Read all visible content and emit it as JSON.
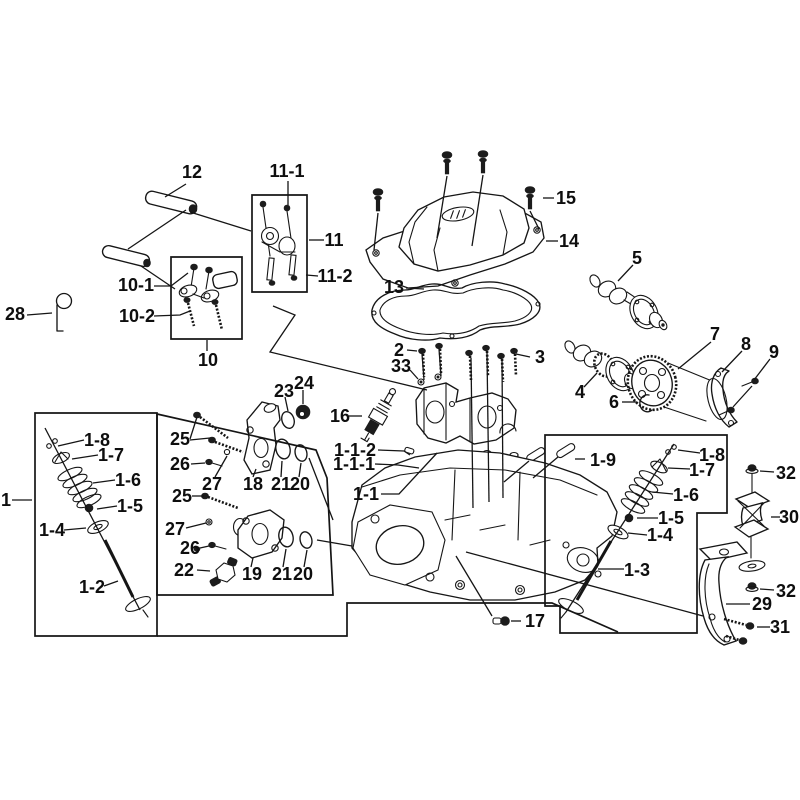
{
  "figure": {
    "type": "exploded-parts-diagram",
    "subject": "engine cylinder head assembly",
    "background_color": "#ffffff",
    "line_color": "#151515",
    "label_color": "#0e0e0e"
  },
  "labels": [
    {
      "id": "label-12",
      "t": "12",
      "x": 192,
      "y": 172
    },
    {
      "id": "label-11-1",
      "t": "11-1",
      "x": 287,
      "y": 171
    },
    {
      "id": "label-11",
      "t": "11",
      "x": 334,
      "y": 240
    },
    {
      "id": "label-11-2",
      "t": "11-2",
      "x": 335,
      "y": 276
    },
    {
      "id": "label-10-1",
      "t": "10-1",
      "x": 136,
      "y": 285
    },
    {
      "id": "label-10-2",
      "t": "10-2",
      "x": 137,
      "y": 316
    },
    {
      "id": "label-10",
      "t": "10",
      "x": 208,
      "y": 360
    },
    {
      "id": "label-28",
      "t": "28",
      "x": 15,
      "y": 314
    },
    {
      "id": "label-15",
      "t": "15",
      "x": 566,
      "y": 198
    },
    {
      "id": "label-14",
      "t": "14",
      "x": 569,
      "y": 241
    },
    {
      "id": "label-13",
      "t": "13",
      "x": 394,
      "y": 287
    },
    {
      "id": "label-5",
      "t": "5",
      "x": 637,
      "y": 258
    },
    {
      "id": "label-7",
      "t": "7",
      "x": 715,
      "y": 334
    },
    {
      "id": "label-8",
      "t": "8",
      "x": 746,
      "y": 344
    },
    {
      "id": "label-9",
      "t": "9",
      "x": 774,
      "y": 352
    },
    {
      "id": "label-4",
      "t": "4",
      "x": 580,
      "y": 392
    },
    {
      "id": "label-6",
      "t": "6",
      "x": 614,
      "y": 402
    },
    {
      "id": "label-2",
      "t": "2",
      "x": 399,
      "y": 350
    },
    {
      "id": "label-33",
      "t": "33",
      "x": 401,
      "y": 366
    },
    {
      "id": "label-3",
      "t": "3",
      "x": 540,
      "y": 357
    },
    {
      "id": "label-16",
      "t": "16",
      "x": 340,
      "y": 416
    },
    {
      "id": "label-1-1-2",
      "t": "1-1-2",
      "x": 355,
      "y": 450
    },
    {
      "id": "label-1-1-1",
      "t": "1-1-1",
      "x": 354,
      "y": 464
    },
    {
      "id": "label-1-1",
      "t": "1-1",
      "x": 366,
      "y": 494
    },
    {
      "id": "label-1",
      "t": "1",
      "x": 6,
      "y": 500
    },
    {
      "id": "label-1-8-left",
      "t": "1-8",
      "x": 97,
      "y": 440
    },
    {
      "id": "label-1-7-left",
      "t": "1-7",
      "x": 111,
      "y": 455
    },
    {
      "id": "label-1-6-left",
      "t": "1-6",
      "x": 128,
      "y": 480
    },
    {
      "id": "label-1-5-left",
      "t": "1-5",
      "x": 130,
      "y": 506
    },
    {
      "id": "label-1-4-left",
      "t": "1-4",
      "x": 52,
      "y": 530
    },
    {
      "id": "label-1-2",
      "t": "1-2",
      "x": 92,
      "y": 587
    },
    {
      "id": "label-23",
      "t": "23",
      "x": 284,
      "y": 391
    },
    {
      "id": "label-24",
      "t": "24",
      "x": 304,
      "y": 383
    },
    {
      "id": "label-25-top",
      "t": "25",
      "x": 180,
      "y": 439
    },
    {
      "id": "label-26-top",
      "t": "26",
      "x": 180,
      "y": 464
    },
    {
      "id": "label-27-top",
      "t": "27",
      "x": 212,
      "y": 484
    },
    {
      "id": "label-18",
      "t": "18",
      "x": 253,
      "y": 484
    },
    {
      "id": "label-21-top",
      "t": "21",
      "x": 281,
      "y": 484
    },
    {
      "id": "label-20-top",
      "t": "20",
      "x": 300,
      "y": 484
    },
    {
      "id": "label-25-bottom",
      "t": "25",
      "x": 182,
      "y": 496
    },
    {
      "id": "label-27-bottom",
      "t": "27",
      "x": 175,
      "y": 529
    },
    {
      "id": "label-26-bottom",
      "t": "26",
      "x": 190,
      "y": 548
    },
    {
      "id": "label-22",
      "t": "22",
      "x": 184,
      "y": 570
    },
    {
      "id": "label-19",
      "t": "19",
      "x": 252,
      "y": 574
    },
    {
      "id": "label-21-bottom",
      "t": "21",
      "x": 282,
      "y": 574
    },
    {
      "id": "label-20-bottom",
      "t": "20",
      "x": 303,
      "y": 574
    },
    {
      "id": "label-1-9",
      "t": "1-9",
      "x": 603,
      "y": 460
    },
    {
      "id": "label-1-8-right",
      "t": "1-8",
      "x": 712,
      "y": 455
    },
    {
      "id": "label-1-7-right",
      "t": "1-7",
      "x": 702,
      "y": 470
    },
    {
      "id": "label-1-6-right",
      "t": "1-6",
      "x": 686,
      "y": 495
    },
    {
      "id": "label-1-5-right",
      "t": "1-5",
      "x": 671,
      "y": 518
    },
    {
      "id": "label-1-4-right",
      "t": "1-4",
      "x": 660,
      "y": 535
    },
    {
      "id": "label-1-3",
      "t": "1-3",
      "x": 637,
      "y": 570
    },
    {
      "id": "label-32-top",
      "t": "32",
      "x": 786,
      "y": 473
    },
    {
      "id": "label-30",
      "t": "30",
      "x": 789,
      "y": 517
    },
    {
      "id": "label-32-bottom",
      "t": "32",
      "x": 786,
      "y": 591
    },
    {
      "id": "label-29",
      "t": "29",
      "x": 762,
      "y": 604
    },
    {
      "id": "label-31",
      "t": "31",
      "x": 780,
      "y": 627
    },
    {
      "id": "label-17",
      "t": "17",
      "x": 535,
      "y": 621
    }
  ],
  "callout_boxes": [
    {
      "id": "group-box-valve-left",
      "closed": true,
      "pts": "35,413 157,413 157,636 35,636"
    },
    {
      "id": "group-box-manifolds",
      "closed": true,
      "pts": "157,414 316,450 327,478 333,595 157,595"
    },
    {
      "id": "group-outline-head-band",
      "closed": false,
      "pts": "157,636 347,636 347,603 552,603 618,632"
    },
    {
      "id": "group-box-valve-right",
      "closed": true,
      "pts": "545,435 727,435 727,513 697,513 697,633 560,633 560,606 545,606"
    },
    {
      "id": "group-box-rocker-10",
      "closed": true,
      "pts": "171,257 242,257 242,339 171,339"
    },
    {
      "id": "group-box-rocker-11",
      "closed": true,
      "pts": "252,195 307,195 307,292 252,292"
    }
  ],
  "leader_lines": [
    {
      "id": "ld-12",
      "pts": "186,184 165,197"
    },
    {
      "id": "ld-12-axis",
      "pts": "186,210 128,249"
    },
    {
      "id": "ld-pin-box10",
      "pts": "141,266 175,289"
    },
    {
      "id": "ld-pin-box11",
      "pts": "190,212 251,231"
    },
    {
      "id": "ld-11-1",
      "pts": "288,181 288,205"
    },
    {
      "id": "ld-11",
      "pts": "309,240 324,240"
    },
    {
      "id": "ld-11-2",
      "pts": "306,275 318,276"
    },
    {
      "id": "ld-10-1",
      "pts": "154,286 171,286 188,273"
    },
    {
      "id": "ld-10-2",
      "pts": "154,316 180,315 190,311"
    },
    {
      "id": "ld-10",
      "pts": "207,351 207,340"
    },
    {
      "id": "ld-28",
      "pts": "27,315 52,313"
    },
    {
      "id": "ld-15",
      "pts": "543,198 554,198"
    },
    {
      "id": "ld-14",
      "pts": "546,241 558,241"
    },
    {
      "id": "ld-13",
      "pts": "406,288 424,289"
    },
    {
      "id": "ld-5",
      "pts": "633,265 618,281"
    },
    {
      "id": "ld-4",
      "pts": "584,387 597,373"
    },
    {
      "id": "ld-7",
      "pts": "711,342 678,369"
    },
    {
      "id": "ld-8",
      "pts": "742,351 722,372"
    },
    {
      "id": "ld-9",
      "pts": "770,359 754,380"
    },
    {
      "id": "ld-9b",
      "pts": "752,386 733,407"
    },
    {
      "id": "ld-6",
      "pts": "622,402 637,402"
    },
    {
      "id": "ld-2",
      "pts": "407,350 417,351"
    },
    {
      "id": "ld-33",
      "pts": "410,370 418,379"
    },
    {
      "id": "ld-3",
      "pts": "530,357 516,354"
    },
    {
      "id": "ld-16",
      "pts": "349,416 362,416"
    },
    {
      "id": "ld-1-1-2",
      "pts": "378,450 404,451 410,455"
    },
    {
      "id": "ld-1-1-1",
      "pts": "375,464 398,465 419,468"
    },
    {
      "id": "ld-1-1",
      "pts": "381,494 399,494 437,453"
    },
    {
      "id": "ld-1",
      "pts": "12,500 32,500"
    },
    {
      "id": "ld-1-8L",
      "pts": "84,440 58,446"
    },
    {
      "id": "ld-1-7L",
      "pts": "98,455 72,459"
    },
    {
      "id": "ld-1-6L",
      "pts": "115,480 93,483"
    },
    {
      "id": "ld-1-5L",
      "pts": "117,506 97,509"
    },
    {
      "id": "ld-1-4L",
      "pts": "64,530 86,528"
    },
    {
      "id": "ld-1-2",
      "pts": "104,586 118,581"
    },
    {
      "id": "ld-23",
      "pts": "285,397 288,411"
    },
    {
      "id": "ld-24",
      "pts": "303,390 303,404"
    },
    {
      "id": "ld-25a",
      "pts": "190,439 197,417"
    },
    {
      "id": "ld-25a2",
      "pts": "190,440 210,438"
    },
    {
      "id": "ld-26a",
      "pts": "191,464 205,463"
    },
    {
      "id": "ld-27a",
      "pts": "215,477 227,456"
    },
    {
      "id": "ld-18",
      "pts": "253,477 256,469"
    },
    {
      "id": "ld-21a",
      "pts": "281,477 282,461"
    },
    {
      "id": "ld-20a",
      "pts": "299,477 301,463"
    },
    {
      "id": "ld-25b",
      "pts": "192,496 204,496"
    },
    {
      "id": "ld-27b",
      "pts": "186,528 206,523"
    },
    {
      "id": "ld-26b",
      "pts": "200,548 209,546"
    },
    {
      "id": "ld-22",
      "pts": "197,570 210,571"
    },
    {
      "id": "ld-19",
      "pts": "251,567 253,558"
    },
    {
      "id": "ld-21b",
      "pts": "283,567 286,549"
    },
    {
      "id": "ld-20b",
      "pts": "304,567 307,550"
    },
    {
      "id": "ld-oring-head-1",
      "pts": "309,458 333,520"
    },
    {
      "id": "ld-oring-head-2",
      "pts": "317,540 352,546"
    },
    {
      "id": "ld-1-9",
      "pts": "575,459 585,459"
    },
    {
      "id": "ld-pin-a",
      "pts": "529,461 504,482"
    },
    {
      "id": "ld-pin-b",
      "pts": "558,457 533,478"
    },
    {
      "id": "ld-1-8R",
      "pts": "700,453 678,450"
    },
    {
      "id": "ld-1-7R",
      "pts": "690,469 668,468"
    },
    {
      "id": "ld-1-6R",
      "pts": "673,494 652,492"
    },
    {
      "id": "ld-1-5R",
      "pts": "658,518 637,518"
    },
    {
      "id": "ld-1-4R",
      "pts": "647,535 628,533"
    },
    {
      "id": "ld-1-3",
      "pts": "624,569 598,569"
    },
    {
      "id": "ld-32a",
      "pts": "760,471 774,472"
    },
    {
      "id": "ld-30",
      "pts": "771,517 780,517"
    },
    {
      "id": "ld-32b",
      "pts": "760,589 774,590"
    },
    {
      "id": "ld-29",
      "pts": "726,604 750,604"
    },
    {
      "id": "ld-31",
      "pts": "757,627 770,627"
    },
    {
      "id": "ld-17-diag",
      "pts": "456,556 492,616"
    },
    {
      "id": "ld-17",
      "pts": "511,621 521,621"
    },
    {
      "id": "ld-29-long",
      "pts": "466,552 703,616"
    },
    {
      "id": "ld-zigzag-11",
      "pts": "273,306 295,315 270,352 427,390"
    },
    {
      "id": "ld-axis-left-valve",
      "pts": "45,428 140,610"
    },
    {
      "id": "ld-axis-right-valve",
      "pts": "674,444 566,612"
    },
    {
      "id": "ld-bolt15-1",
      "pts": "378,213 374,250"
    },
    {
      "id": "ld-bolt15-2",
      "pts": "447,176 437,238"
    },
    {
      "id": "ld-bolt15-3",
      "pts": "483,175 472,246"
    },
    {
      "id": "ld-bolt15-4",
      "pts": "530,211 539,229"
    },
    {
      "id": "ld-stud3-1",
      "pts": "471,358 473,508"
    },
    {
      "id": "ld-stud3-2",
      "pts": "487,353 489,502"
    },
    {
      "id": "ld-stud3-3",
      "pts": "502,360 503,498"
    },
    {
      "id": "ld-bolt2-1",
      "pts": "422,354 424,380"
    },
    {
      "id": "ld-bolt2-2",
      "pts": "439,349 441,376"
    }
  ]
}
